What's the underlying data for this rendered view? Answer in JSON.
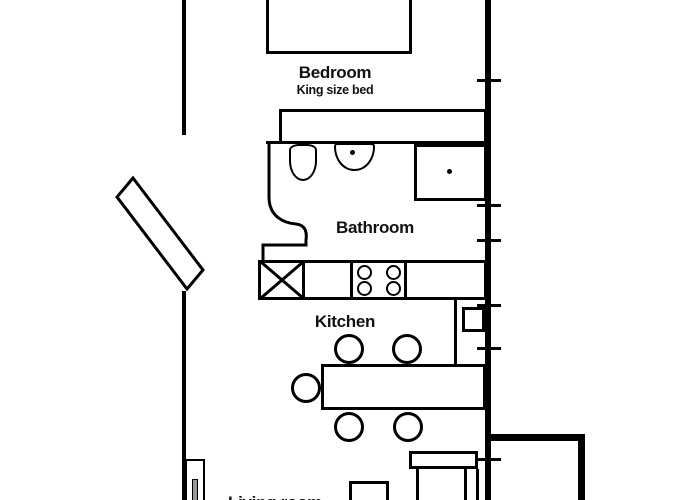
{
  "canvas": {
    "background": "#ffffff",
    "line_color": "#000000",
    "text_color": "#111111"
  },
  "labels": {
    "bedroom": "Bedroom",
    "bedroom_sub": "King size bed",
    "bathroom": "Bathroom",
    "kitchen": "Kitchen",
    "living_room": "Living room"
  }
}
